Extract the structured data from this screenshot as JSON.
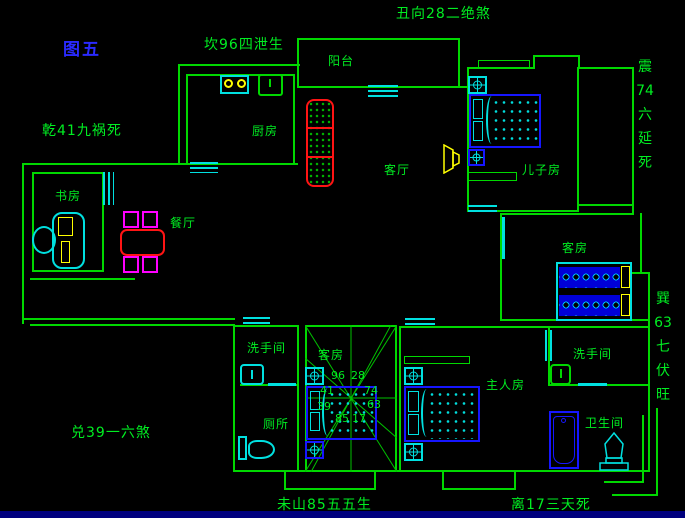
{
  "figure_title": "图五",
  "annotations": {
    "north": "坎96四泄生",
    "northeast": "丑向28二绝煞",
    "northwest": "乾41九祸死",
    "east": [
      "震",
      "74",
      "六",
      "延",
      "死"
    ],
    "southeast": [
      "巽",
      "63",
      "七",
      "伏",
      "旺"
    ],
    "west": "兑39一六煞",
    "southwest": "未山85五五生",
    "south": "离17三天死"
  },
  "rooms": {
    "balcony": "阳台",
    "kitchen": "厨房",
    "living": "客厅",
    "sons_room": "儿子房",
    "study": "书房",
    "dining": "餐厅",
    "guest_right": "客房",
    "guest_center": "客房",
    "wash_left": "洗手间",
    "toilet": "厕所",
    "master": "主人房",
    "wash_right": "洗手间",
    "bathroom": "卫生间"
  },
  "compass_numbers": {
    "nw": "96",
    "ne": "28",
    "wnw": "41",
    "ene": "74",
    "w": "39",
    "e": "63",
    "sw": "85",
    "se": "17"
  },
  "colors": {
    "wall": "#00d800",
    "fixture": "#00e0e0",
    "bed": "#1616ff",
    "accent_red": "#ff1414",
    "accent_magenta": "#ff00ff",
    "accent_yellow": "#ffff00",
    "figure_label": "#2a2aff",
    "taskbar": "#00007e"
  }
}
